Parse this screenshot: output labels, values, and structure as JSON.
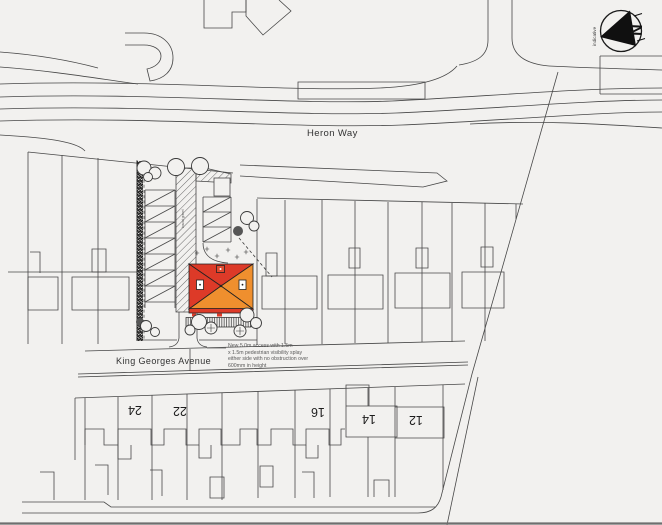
{
  "drawing": {
    "type": "site-plan",
    "background": "#f2f1ef"
  },
  "north_arrow": {
    "letter": "N",
    "caption": "indicative"
  },
  "streets": {
    "heron_way": "Heron Way",
    "king_georges_avenue": "King Georges Avenue"
  },
  "annotation": {
    "line1": "New 5.0m access with 1.5m",
    "line2": "x 1.5m pedestrian visibility splay",
    "line3": "either side with no obstruction over",
    "line4": "600mm in height"
  },
  "site": {
    "drive_surface_label": "bound gravel"
  },
  "house_numbers": [
    "24",
    "22",
    "16",
    "14",
    "12"
  ],
  "colors": {
    "roof_red": "#dd3a28",
    "roof_orange": "#ef8f2e",
    "line": "#454545"
  }
}
